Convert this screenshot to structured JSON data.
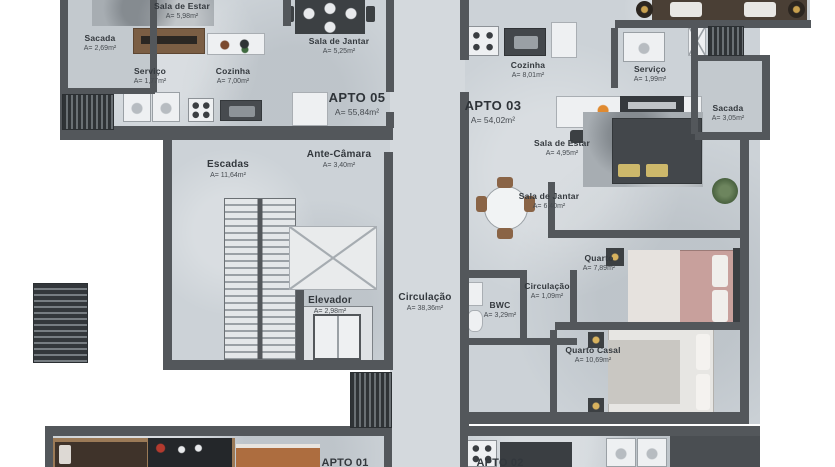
{
  "apartments": {
    "apto05": {
      "label": "APTO 05",
      "area": "A= 55,84m²"
    },
    "apto03": {
      "label": "APTO 03",
      "area": "A= 54,02m²"
    },
    "apto01": {
      "label": "APTO 01"
    },
    "apto02": {
      "label": "APTO 02"
    }
  },
  "rooms": {
    "sacada_esq": {
      "name": "Sacada",
      "area": "A= 2,69m²"
    },
    "sala_estar_esq": {
      "name": "Sala de Estar",
      "area": "A= 5,98m²"
    },
    "sala_jantar_esq": {
      "name": "Sala de Jantar",
      "area": "A= 5,25m²"
    },
    "servico_esq": {
      "name": "Serviço",
      "area": "A= 1,77m²"
    },
    "cozinha_esq": {
      "name": "Cozinha",
      "area": "A= 7,00m²"
    },
    "escadas": {
      "name": "Escadas",
      "area": "A= 11,64m²"
    },
    "ante_camara": {
      "name": "Ante-Câmara",
      "area": "A= 3,40m²"
    },
    "elevador": {
      "name": "Elevador",
      "area": "A= 2,98m²"
    },
    "circulacao": {
      "name": "Circulação",
      "area": "A= 38,36m²"
    },
    "cozinha_dir": {
      "name": "Cozinha",
      "area": "A= 8,01m²"
    },
    "servico_dir": {
      "name": "Serviço",
      "area": "A= 1,99m²"
    },
    "sacada_dir": {
      "name": "Sacada",
      "area": "A= 3,05m²"
    },
    "sala_estar_dir": {
      "name": "Sala de Estar",
      "area": "A= 4,95m²"
    },
    "sala_jantar_dir": {
      "name": "Sala de Jantar",
      "area": "A= 6,40m²"
    },
    "quarto": {
      "name": "Quarto",
      "area": "A= 7,89m²"
    },
    "circulacao_int": {
      "name": "Circulação",
      "area": "A= 1,09m²"
    },
    "bwc": {
      "name": "BWC",
      "area": "A= 3,29m²"
    },
    "quarto_casal": {
      "name": "Quarto Casal",
      "area": "A= 10,69m²"
    }
  },
  "colors": {
    "wall": "#53575b",
    "floor": "#ccd2d7",
    "corridor": "#d4d9dd",
    "wood": "#7b5e44",
    "text": "#33383d",
    "bed_pink": "#c8a09c",
    "pillow_yellow": "#cdb86b",
    "plant_green": "#5a7350",
    "flower_orange": "#e08a30"
  }
}
